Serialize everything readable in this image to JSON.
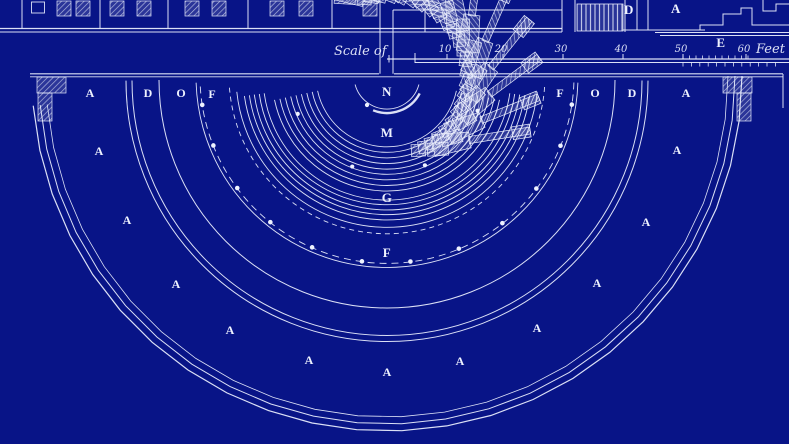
{
  "meta": {
    "title": "Antique theatre ground-plan blueprint"
  },
  "colors": {
    "background": "#081487",
    "ink": "#eef2ff"
  },
  "scale_bar": {
    "label": "Scale of",
    "unit": "Feet",
    "ticks": [
      {
        "value": "10",
        "x": 447
      },
      {
        "value": "20",
        "x": 503
      },
      {
        "value": "30",
        "x": 563
      },
      {
        "value": "40",
        "x": 623
      },
      {
        "value": "50",
        "x": 683
      },
      {
        "value": "60",
        "x": 746
      }
    ]
  },
  "stage_labels": [
    {
      "text": "D",
      "x": 629,
      "y": 14
    },
    {
      "text": "A",
      "x": 676,
      "y": 13
    },
    {
      "text": "E",
      "x": 721,
      "y": 47
    }
  ],
  "ring_labels": [
    {
      "text": "A",
      "x": 90,
      "y": 97
    },
    {
      "text": "D",
      "x": 148,
      "y": 97
    },
    {
      "text": "O",
      "x": 181,
      "y": 97
    },
    {
      "text": "F",
      "x": 212,
      "y": 98
    },
    {
      "text": "F",
      "x": 560,
      "y": 97
    },
    {
      "text": "O",
      "x": 595,
      "y": 97
    },
    {
      "text": "D",
      "x": 632,
      "y": 97
    },
    {
      "text": "A",
      "x": 686,
      "y": 97
    }
  ],
  "axis_labels": [
    {
      "text": "N",
      "x": 387,
      "y": 96
    },
    {
      "text": "M",
      "x": 387,
      "y": 137
    },
    {
      "text": "G",
      "x": 387,
      "y": 202
    },
    {
      "text": "F",
      "x": 387,
      "y": 257
    }
  ],
  "cavea_labels": [
    {
      "text": "A",
      "x": 99,
      "y": 155
    },
    {
      "text": "A",
      "x": 127,
      "y": 224
    },
    {
      "text": "A",
      "x": 176,
      "y": 288
    },
    {
      "text": "A",
      "x": 230,
      "y": 334
    },
    {
      "text": "A",
      "x": 309,
      "y": 364
    },
    {
      "text": "A",
      "x": 387,
      "y": 376
    },
    {
      "text": "A",
      "x": 460,
      "y": 365
    },
    {
      "text": "A",
      "x": 537,
      "y": 332
    },
    {
      "text": "A",
      "x": 597,
      "y": 287
    },
    {
      "text": "A",
      "x": 646,
      "y": 226
    },
    {
      "text": "A",
      "x": 677,
      "y": 154
    }
  ],
  "geometry": {
    "center": {
      "x": 387,
      "y": 76
    },
    "arcs": [
      {
        "r": 33,
        "a1": 15,
        "a2": 165,
        "w": 0.9
      },
      {
        "r": 37,
        "a1": 28,
        "a2": 112,
        "w": 2.4
      },
      {
        "r": 71,
        "a1": 12,
        "a2": 168,
        "w": 0.9
      },
      {
        "r": 76.5,
        "a1": 12,
        "a2": 168,
        "w": 0.9
      },
      {
        "r": 82,
        "a1": 12,
        "a2": 168,
        "w": 0.9
      },
      {
        "r": 87.5,
        "a1": 12,
        "a2": 168,
        "w": 0.9
      },
      {
        "r": 93,
        "a1": 12,
        "a2": 168,
        "w": 0.9
      },
      {
        "r": 98.5,
        "a1": 12,
        "a2": 168,
        "w": 0.9
      },
      {
        "r": 104,
        "a1": 12,
        "a2": 168,
        "w": 0.9
      },
      {
        "r": 109.5,
        "a1": 12,
        "a2": 168,
        "w": 0.9
      },
      {
        "r": 115,
        "a1": 12,
        "a2": 168,
        "w": 0.9
      },
      {
        "r": 124,
        "a1": 8,
        "a2": 172,
        "w": 0.9
      },
      {
        "r": 129,
        "a1": 8,
        "a2": 172,
        "w": 0.9
      },
      {
        "r": 134,
        "a1": 8,
        "a2": 172,
        "w": 0.9
      },
      {
        "r": 139,
        "a1": 8,
        "a2": 172,
        "w": 0.9
      },
      {
        "r": 144,
        "a1": 8,
        "a2": 172,
        "w": 0.9
      },
      {
        "r": 151,
        "a1": 6,
        "a2": 174,
        "w": 0.9
      },
      {
        "r": 158,
        "a1": 4,
        "a2": 176,
        "w": 0.9,
        "dash": "5 4"
      },
      {
        "r": 187,
        "a1": 2,
        "a2": 178,
        "w": 0.9,
        "dash": "7 5"
      },
      {
        "r": 191,
        "a1": 2,
        "a2": 178,
        "w": 0.9
      },
      {
        "r": 228,
        "a1": 1,
        "a2": 179,
        "w": 1
      },
      {
        "r": 255,
        "a1": 1,
        "a2": 179,
        "w": 1
      },
      {
        "r": 261,
        "a1": 1,
        "a2": 179,
        "w": 1
      }
    ],
    "spoke_angles": [
      8.8,
      21.9,
      37,
      51.9,
      67.4,
      82.8,
      97.7,
      113.6,
      128.6,
      143.2,
      158.2,
      171.1
    ],
    "bay_angles": [
      3.3,
      14.3,
      29.4,
      44.6,
      59.2,
      75.6,
      90,
      105.4,
      121.7,
      135.4,
      151,
      165.4,
      176.7
    ],
    "wall": {
      "radii": [
        341,
        348,
        355
      ],
      "step_deg": 7.3
    },
    "dots": {
      "arc_r187_angles": [
        8.8,
        21.9,
        37,
        51.9,
        67.4,
        82.8,
        97.7,
        113.6,
        128.6,
        143.2,
        158.2,
        171.1
      ],
      "arc_r97_angles": [
        21,
        67,
        111,
        157
      ],
      "extra_points": [
        {
          "x": 367,
          "y": 105
        }
      ]
    },
    "ruler": {
      "x_start": 387,
      "x_end": 789,
      "y_top": 59,
      "y_bot": 62.5,
      "zero_tick_x": 389,
      "start_tick_x": 415,
      "fine_ticks": {
        "from": 683,
        "to": 748,
        "step": 6.5
      },
      "sub_ticks": {
        "from": 683,
        "to": 783,
        "step": 8.4
      }
    }
  }
}
